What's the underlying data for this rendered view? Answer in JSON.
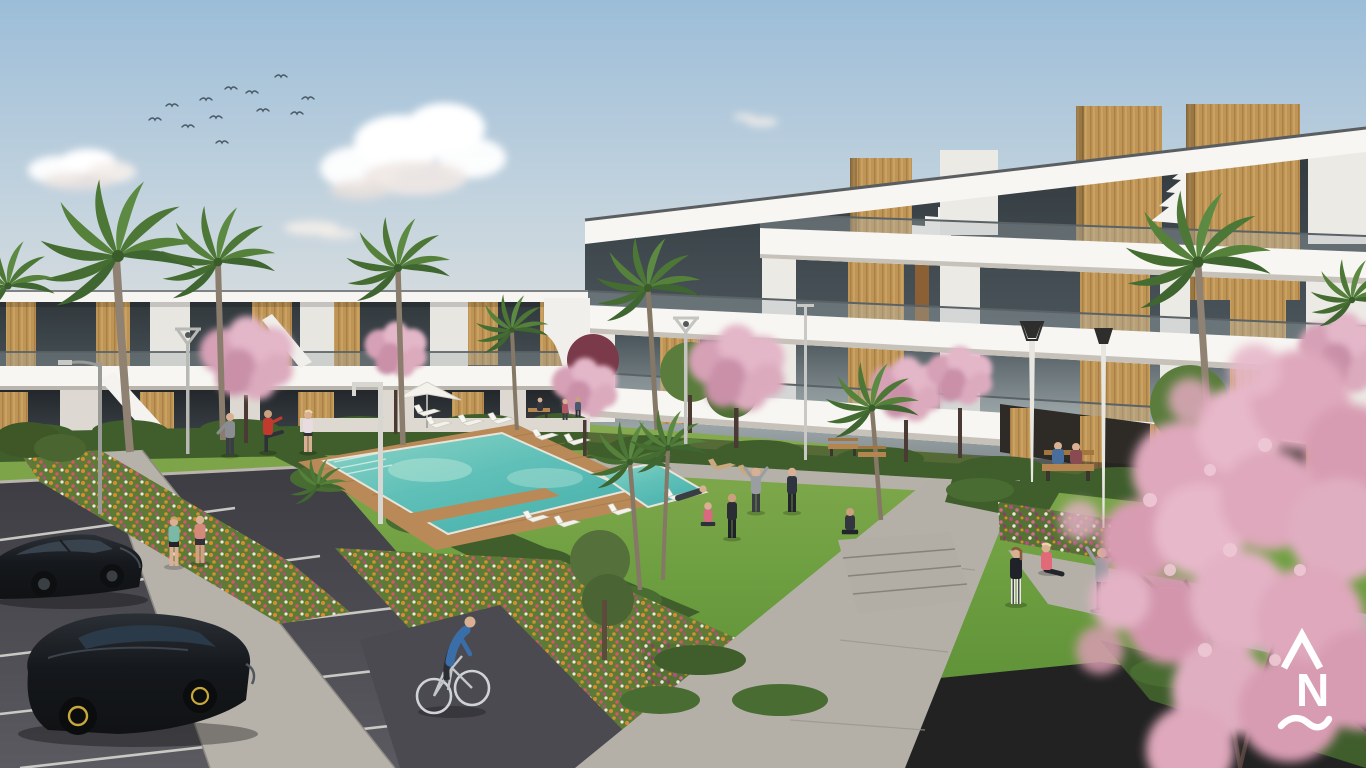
{
  "meta": {
    "type": "architectural-render",
    "description": "3D rendering of a modern white residential apartment complex with wooden accent panels, communal pool, lawns, flower beds, palm and cherry-blossom trees, parking lot and residents exercising outdoors"
  },
  "watermark": {
    "top_symbol": "caret",
    "letter": "N",
    "bottom_symbol": "wave",
    "color": "#ffffff"
  },
  "palette": {
    "sky_top": "#9cbdd8",
    "sky_mid": "#c3d3de",
    "sky_horizon": "#eae4d8",
    "cloud_white": "#ffffff",
    "building_white": "#edebe6",
    "building_bright": "#f7f6f2",
    "building_shadow": "#d9d6cf",
    "glass_dark": "#2e3438",
    "glass_light": "#8f999c",
    "wood": "#bf9556",
    "wood_dark": "#a87f45",
    "grass": "#6fa041",
    "grass_dark": "#587f33",
    "hedge": "#3f5e2c",
    "pool_water": "#5fc0b8",
    "pool_shallow": "#b2e3d6",
    "deck_wood": "#b98a58",
    "path_gray": "#b4b0a8",
    "sidewalk": "#b6b2aa",
    "asphalt": "#45454b",
    "marking_white": "#d8d6d0",
    "blossom_pink": "#dfa8bc",
    "blossom_deep": "#c98aa6",
    "flower_orange": "#dd8a2c",
    "flower_magenta": "#b84a86",
    "flower_white": "#efe9dd",
    "car_black": "#1b1e22",
    "wheel_accent": "#c8a83a",
    "skin": "#d9b093",
    "lamp_gray": "#b9b8b4",
    "logo_white": "#ffffff"
  },
  "scene": {
    "sky": {
      "clouds": 3,
      "birds": 12
    },
    "buildings": {
      "left_block_floors": 2,
      "right_block_floors": 3,
      "style": "white render with vertical timber-clad towers, glass balustrade terraces, dark tinted glazing"
    },
    "amenities": {
      "pool": "turquoise pool with timber deck walkways",
      "sun_loungers": 11,
      "parasols": 1,
      "benches": 4,
      "street_lamps": 7
    },
    "vegetation": {
      "palm_trees": 10,
      "cherry_blossom_trees": 8,
      "flower_beds": "orange, pink, magenta and white flowers",
      "hedges": "clipped dark green"
    },
    "vehicles": {
      "cars": 2,
      "car_color": "black",
      "bicycles": 1
    },
    "people": {
      "total": 20,
      "activities": [
        "jogging",
        "cycling",
        "stretching",
        "yoga",
        "walking",
        "sitting on bench",
        "sunbathing"
      ]
    }
  }
}
